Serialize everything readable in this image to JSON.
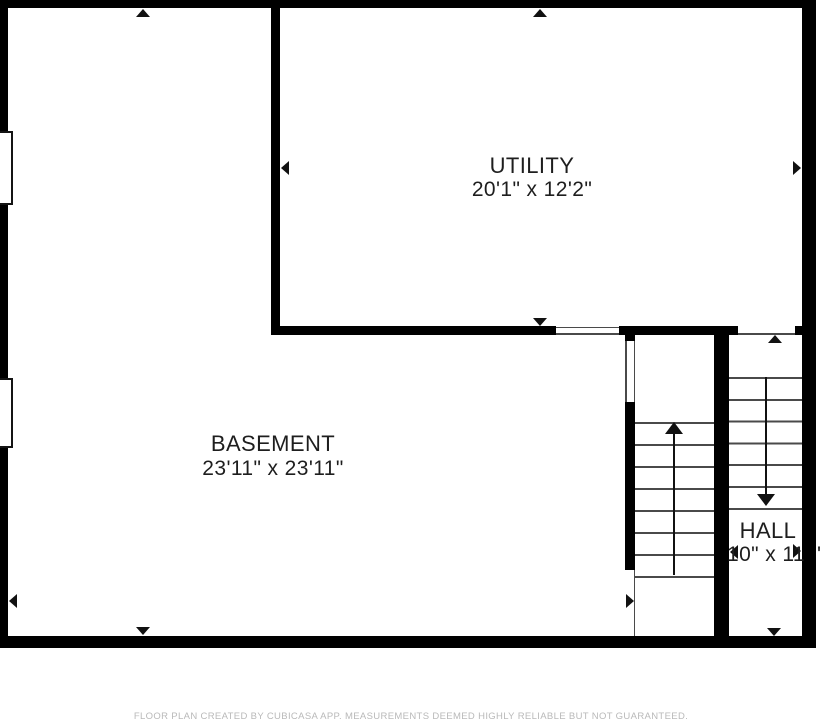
{
  "plan_type": "floor-plan",
  "rooms": [
    {
      "name": "UTILITY",
      "dimensions": "20'1\" x 12'2\""
    },
    {
      "name": "BASEMENT",
      "dimensions": "23'11\" x 23'11\""
    },
    {
      "name": "HALL",
      "dimensions": "10\" x 11",
      "dimension_overflow": "'"
    }
  ],
  "staircase": {
    "lower_flight_treads": 8,
    "upper_flight_treads": 7,
    "lower_flight_direction": "up",
    "upper_flight_direction": "down"
  },
  "features": {
    "windows": 2,
    "wall_openings": 3,
    "dimension_arrows_per_room": [
      "up",
      "down",
      "left",
      "right"
    ]
  },
  "footer": {
    "disclaimer": "FLOOR PLAN CREATED BY CUBICASA APP. MEASUREMENTS DEEMED HIGHLY RELIABLE BUT NOT GUARANTEED."
  },
  "colors": {
    "wall": "#000000",
    "stair_line": "#4a4a4a",
    "label_text": "#1e1e1e",
    "footer_text": "#b9b9b9",
    "background": "#ffffff"
  }
}
